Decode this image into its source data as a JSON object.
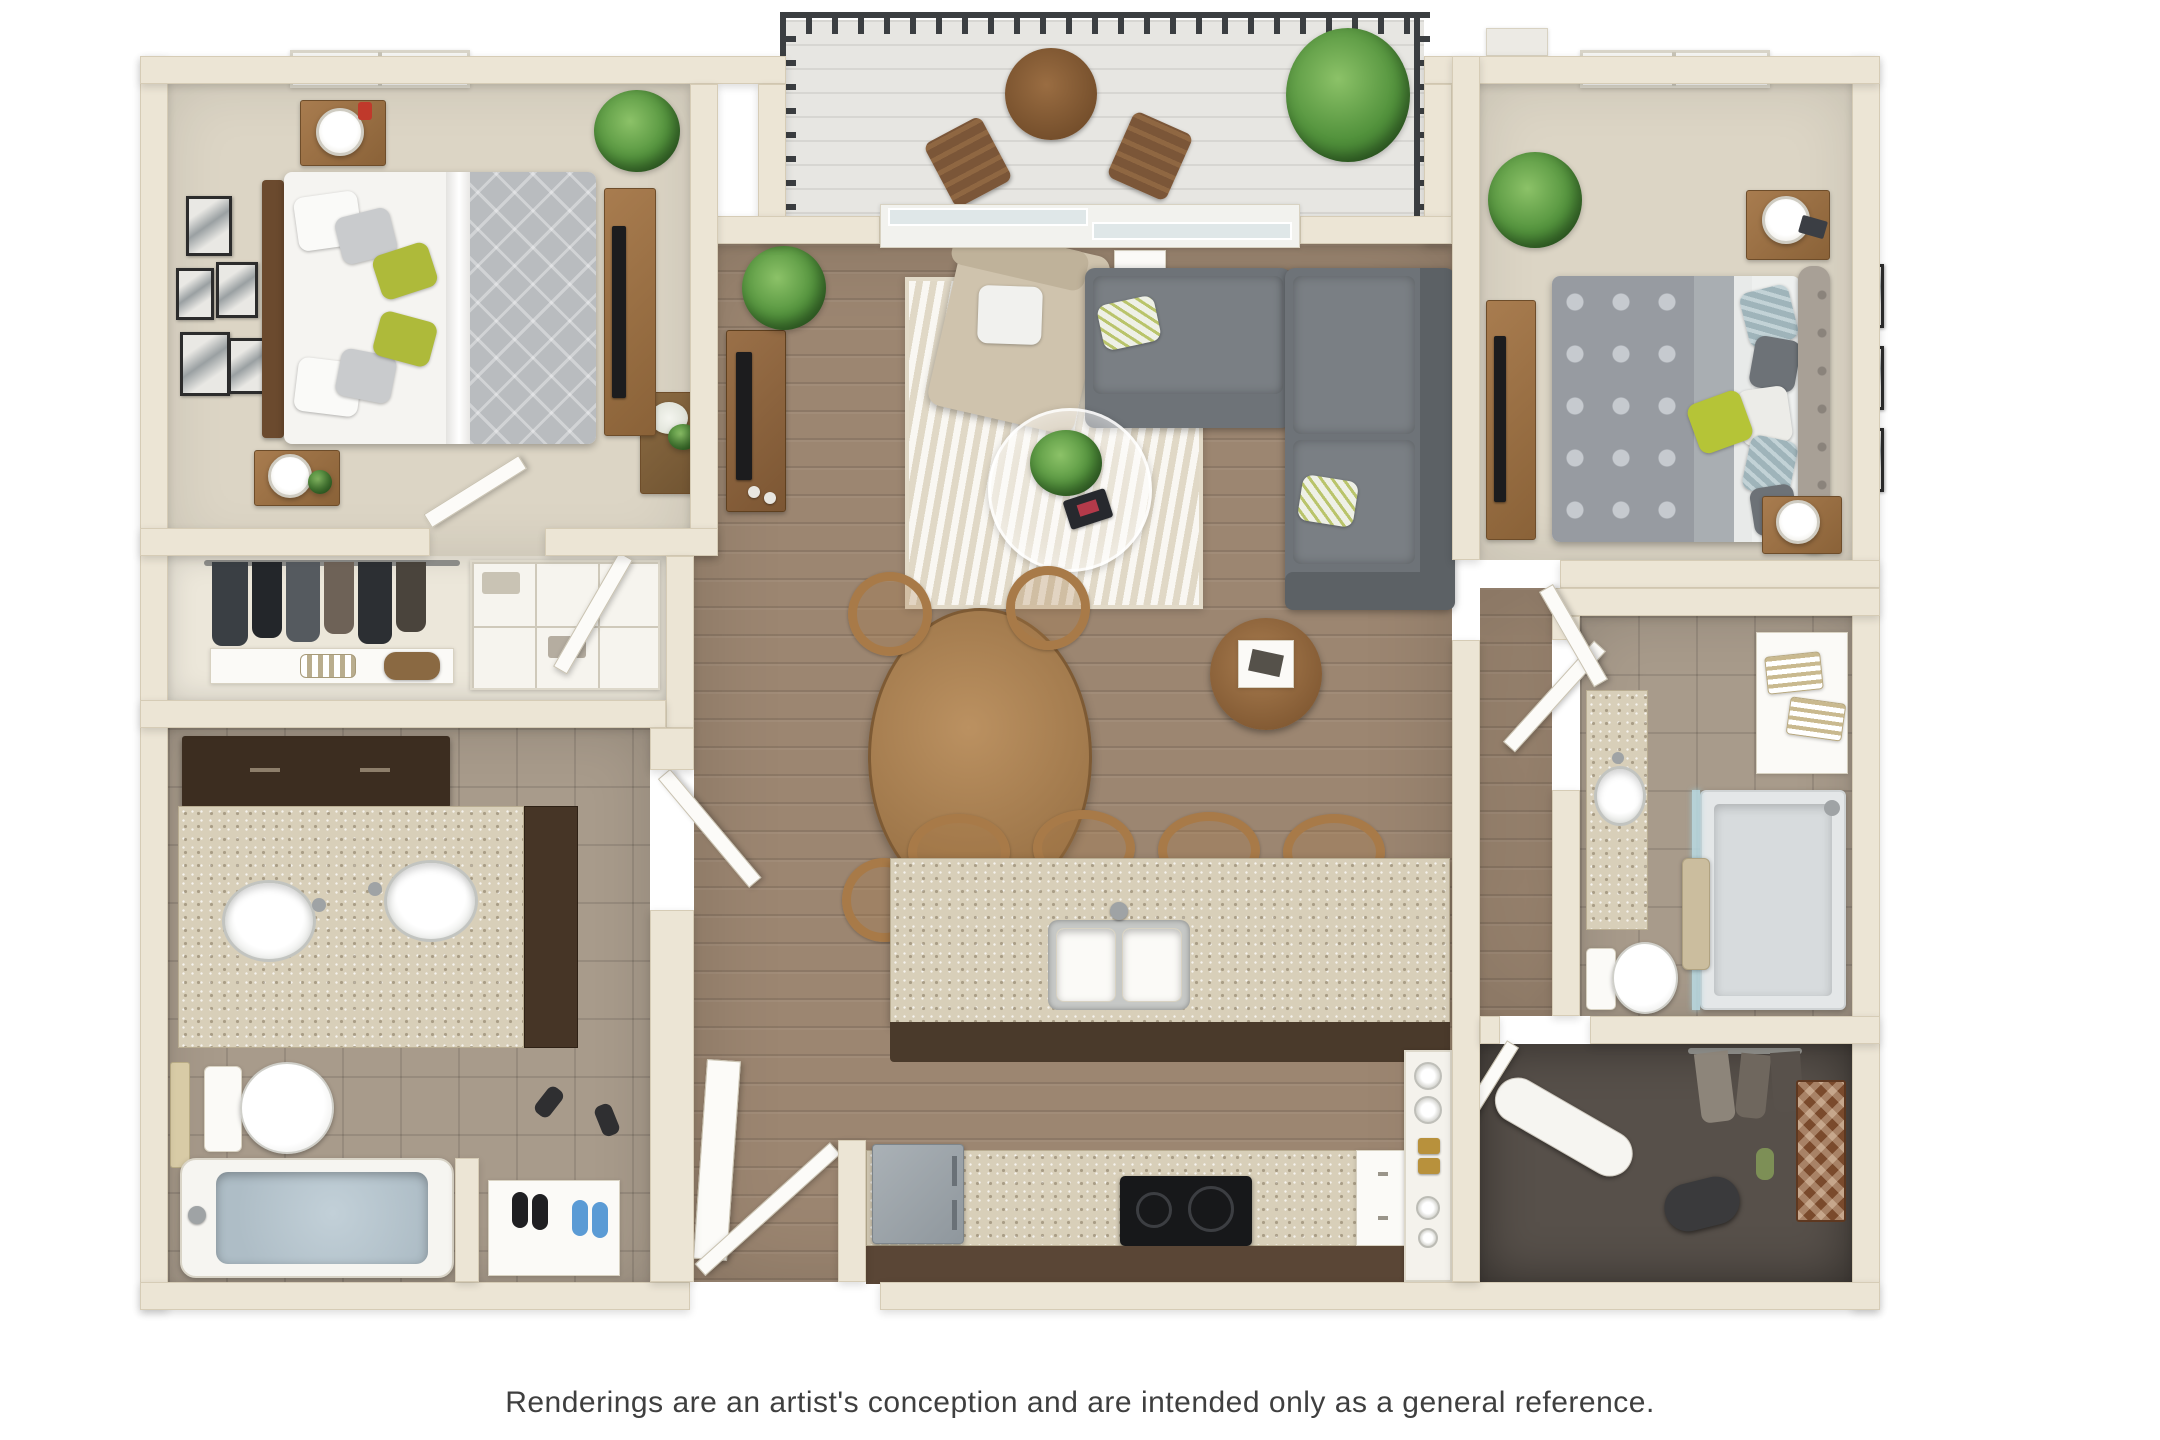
{
  "caption": {
    "text": "Renderings are an artist's conception and are intended only as a general reference."
  },
  "colors": {
    "wall": "#ece5d5",
    "wall_edge": "#d6ccb6",
    "wood_floor": "#9c8671",
    "carpet": "#dcd5c5",
    "tile": "#a89b8b",
    "rug": "#efe8d9",
    "balcony_deck": "#e7e6e2",
    "railing": "#3b3e41",
    "sofa": "#6e7378",
    "armchair": "#cfc3ad",
    "wood_furniture": "#a87c4f",
    "dark_cabinet": "#3c2d20",
    "granite": "#d8cfb9",
    "green_accent": "#aeba3a",
    "water_blue": "#aebdc6",
    "closet_floor": "#57504a",
    "shoe_blue": "#5b9bd5",
    "caption_color": "#3f3f3f"
  },
  "rooms": [
    "bedroom-1",
    "bedroom-2",
    "living-room",
    "dining-area",
    "kitchen",
    "balcony",
    "bathroom-1",
    "bathroom-2",
    "closet",
    "walk-in-closet",
    "entry",
    "hallway",
    "pantry"
  ]
}
